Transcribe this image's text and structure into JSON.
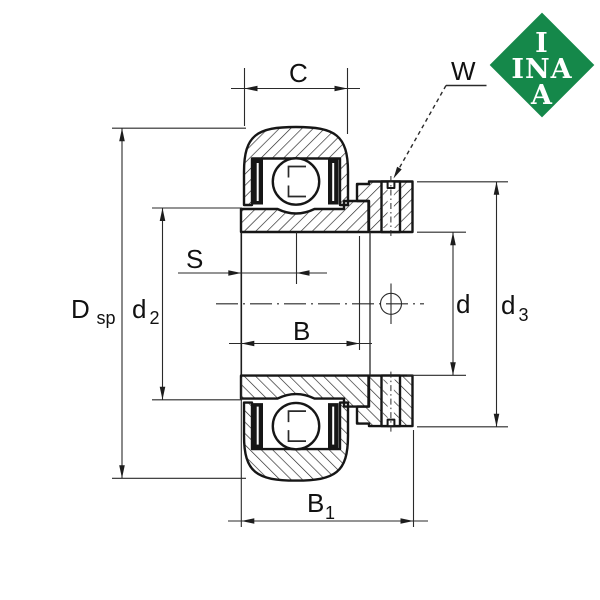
{
  "drawing": {
    "description": "Cross-section technical drawing of an INA radial insert ball bearing with eccentric locking collar and set screw",
    "colors": {
      "ink": "#161616",
      "dim_ink": "#2a2a2a",
      "background": "#ffffff"
    },
    "labels": {
      "C": "C",
      "W": "W",
      "S": "S",
      "B": "B",
      "B1": {
        "main": "B",
        "sub": "1"
      },
      "Dsp": {
        "main": "D",
        "sub": "sp"
      },
      "d2": {
        "main": "d",
        "sub": "2"
      },
      "d": "d",
      "d3": {
        "main": "d",
        "sub": "3"
      }
    }
  },
  "logo": {
    "brand": "INA",
    "lines": [
      "I",
      "INA",
      "A"
    ],
    "bg": "#15884A",
    "fg": "#ffffff"
  }
}
